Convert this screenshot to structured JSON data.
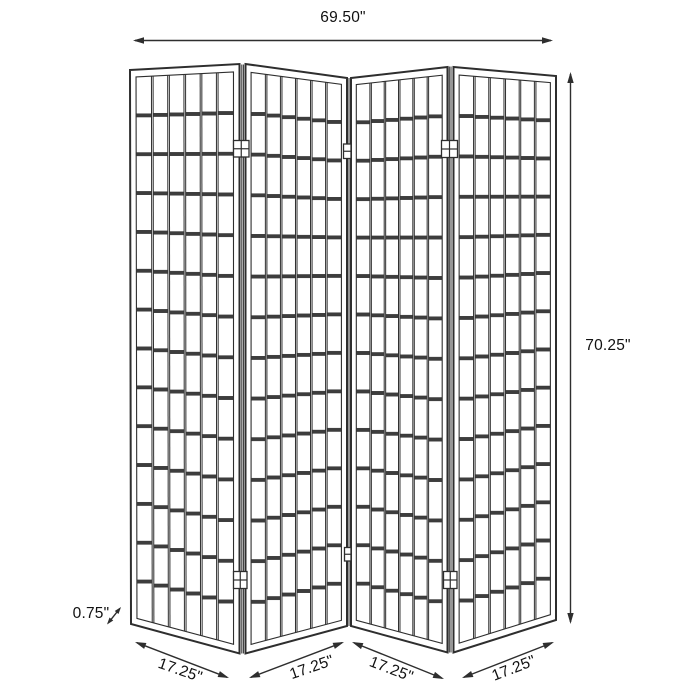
{
  "diagram": {
    "kind": "product-dimension-diagram",
    "subject": "four-panel-shoji-room-divider-screen",
    "colors": {
      "background": "#ffffff",
      "line": "#2e2e2e",
      "rail_fill": "#3d3d3d",
      "text": "#111111"
    },
    "dimensions": {
      "overall_width": "69.50\"",
      "overall_height": "70.25\"",
      "panel_thickness": "0.75\"",
      "panel_widths": [
        "17.25\"",
        "17.25\"",
        "17.25\"",
        "17.25\""
      ]
    },
    "panels": [
      {
        "name": "panel-1",
        "tl": [
          130,
          70
        ],
        "tr": [
          239.5,
          64
        ],
        "br": [
          239.5,
          653.5
        ],
        "bl": [
          131,
          624
        ]
      },
      {
        "name": "panel-2",
        "tl": [
          245.5,
          64
        ],
        "tr": [
          347,
          78
        ],
        "br": [
          347,
          626
        ],
        "bl": [
          245.5,
          653.5
        ]
      },
      {
        "name": "panel-3",
        "tl": [
          351,
          78
        ],
        "tr": [
          447.5,
          67
        ],
        "br": [
          447.5,
          652.5
        ],
        "bl": [
          351,
          626
        ]
      },
      {
        "name": "panel-4",
        "tl": [
          453.5,
          67
        ],
        "tr": [
          556,
          76
        ],
        "br": [
          556,
          620
        ],
        "bl": [
          453.5,
          652.5
        ]
      }
    ],
    "grid": {
      "columns": 6,
      "rows": 14,
      "frame_inset_u": 0.055,
      "frame_inset_v": 0.013,
      "slat_half_gap_u": 0.0076,
      "rail_half_px": 1.7
    },
    "seams": [
      {
        "name": "seam-1-2-a",
        "x": 241.8,
        "y1": 64.5,
        "y2": 653.5
      },
      {
        "name": "seam-1-2-b",
        "x": 243.4,
        "y1": 64.5,
        "y2": 653.5
      },
      {
        "name": "seam-2-3-a",
        "x": 349.0,
        "y1": 78.0,
        "y2": 626.0
      },
      {
        "name": "seam-3-4-a",
        "x": 449.3,
        "y1": 66.5,
        "y2": 652.5
      },
      {
        "name": "seam-3-4-b",
        "x": 451.0,
        "y1": 66.5,
        "y2": 652.5
      }
    ],
    "hinges": [
      {
        "name": "hinge-top-1-2",
        "x": 233.5,
        "y": 140.5,
        "w": 15.5,
        "h": 16.5,
        "style": "cross"
      },
      {
        "name": "hinge-bottom-1-2",
        "x": 233.5,
        "y": 571.5,
        "w": 13.5,
        "h": 17.0,
        "style": "cross"
      },
      {
        "name": "hinge-top-2-3",
        "x": 343.5,
        "y": 144.0,
        "w": 7.5,
        "h": 14.5,
        "style": "h"
      },
      {
        "name": "hinge-bottom-2-3",
        "x": 344.5,
        "y": 547.5,
        "w": 6.5,
        "h": 13.5,
        "style": "h"
      },
      {
        "name": "hinge-top-3-4",
        "x": 441.5,
        "y": 140.5,
        "w": 16.0,
        "h": 17.0,
        "style": "cross"
      },
      {
        "name": "hinge-bottom-3-4",
        "x": 443.5,
        "y": 571.5,
        "w": 13.5,
        "h": 17.0,
        "style": "cross"
      }
    ],
    "arrows": {
      "width": {
        "x1": 133,
        "y1": 40.5,
        "x2": 553,
        "y2": 40.5
      },
      "height": {
        "x1": 570.5,
        "y1": 72,
        "x2": 570.5,
        "y2": 624
      },
      "thickness": {
        "x1": 107,
        "y1": 624.5,
        "x2": 121,
        "y2": 607
      },
      "panel_widths": [
        {
          "x1": 135,
          "y1": 642,
          "x2": 229,
          "y2": 678
        },
        {
          "x1": 249,
          "y1": 678,
          "x2": 344,
          "y2": 642
        },
        {
          "x1": 352,
          "y1": 642,
          "x2": 444,
          "y2": 679
        },
        {
          "x1": 462,
          "y1": 678,
          "x2": 554,
          "y2": 642
        }
      ]
    },
    "labels": {
      "width": {
        "text": "69.50\"",
        "x": 343,
        "y": 18,
        "rotate": 0
      },
      "height": {
        "text": "70.25\"",
        "x": 608,
        "y": 346,
        "rotate": 0
      },
      "thickness": {
        "text": "0.75\"",
        "x": 91,
        "y": 614,
        "rotate": 0
      },
      "panel_widths": [
        {
          "text": "17.25\"",
          "x": 180,
          "y": 671,
          "rotate": 19
        },
        {
          "text": "17.25\"",
          "x": 312,
          "y": 668,
          "rotate": -19
        },
        {
          "text": "17.25\"",
          "x": 391,
          "y": 670,
          "rotate": 21
        },
        {
          "text": "17.25\"",
          "x": 514,
          "y": 669,
          "rotate": -21
        }
      ]
    }
  }
}
